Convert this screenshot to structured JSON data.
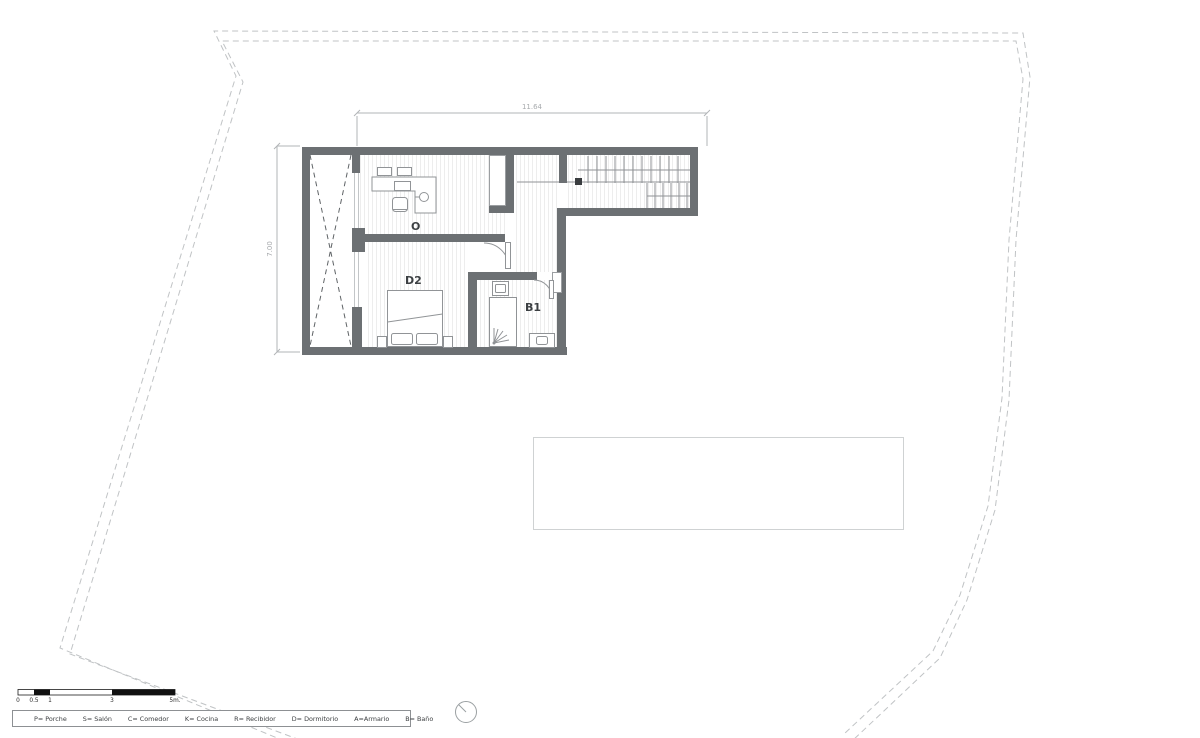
{
  "dimensions": {
    "width": "11.64",
    "height": "7.00"
  },
  "rooms": {
    "office": "O",
    "bedroom": "D2",
    "bathroom": "B1"
  },
  "legend": {
    "items": [
      "P= Porche",
      "S= Salón",
      "C= Comedor",
      "K= Cocina",
      "R= Recibidor",
      "D= Dormitorio",
      "A=Armario",
      "B= Baño"
    ]
  },
  "scale_bar": {
    "labels": [
      "0",
      "0.5",
      "1",
      "3",
      "5m."
    ]
  },
  "colors": {
    "wall": "#6c7073",
    "furniture_line": "#919497",
    "dimension_line": "#b2b5b7",
    "boundary_dash": "#c0c3c5",
    "pool_outline": "#cfd2d3",
    "newel": "#3a3d40"
  }
}
